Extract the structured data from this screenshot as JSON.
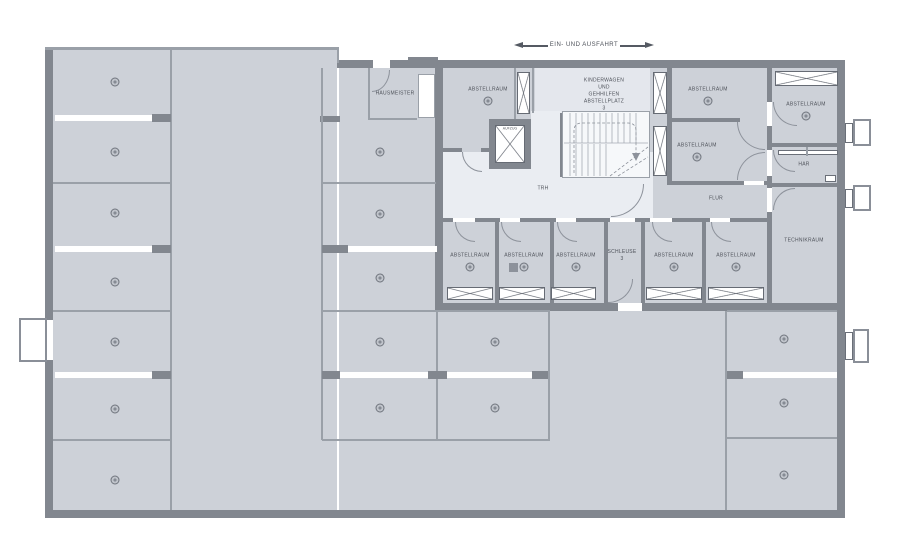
{
  "annotation": {
    "entrance_label": "EIN- UND AUSFAHRT"
  },
  "colors": {
    "floor": "#cdd1d8",
    "floor_light": "#e4e7ed",
    "stair_area": "#f6f8fa",
    "wall": "#82878f",
    "thin_line": "#9aa0a8",
    "label_text": "#4e525a",
    "arrow": "#555a63"
  },
  "rooms": [
    {
      "name": "abstellraum-top-left",
      "label": "ABSTELLRAUM",
      "x": 488,
      "y": 90,
      "marker": true
    },
    {
      "name": "kinderwagen-abstellplatz",
      "label": "KINDERWAGEN UND\nGEHHILFEN\nABSTELLPLATZ 3",
      "x": 604,
      "y": 95,
      "marker": false
    },
    {
      "name": "abstellraum-mid-upper",
      "label": "ABSTELLRAUM",
      "x": 708,
      "y": 90,
      "marker": true
    },
    {
      "name": "abstellraum-mid-lower",
      "label": "ABSTELLRAUM",
      "x": 697,
      "y": 146,
      "marker": true
    },
    {
      "name": "abstellraum-top-right",
      "label": "ABSTELLRAUM",
      "x": 806,
      "y": 105,
      "marker": true
    },
    {
      "name": "har",
      "label": "HAR",
      "x": 804,
      "y": 165,
      "marker": false
    },
    {
      "name": "technikraum",
      "label": "TECHNIKRAUM",
      "x": 804,
      "y": 241,
      "marker": false
    },
    {
      "name": "flur",
      "label": "FLUR",
      "x": 716,
      "y": 199,
      "marker": false
    },
    {
      "name": "trh",
      "label": "TRH",
      "x": 543,
      "y": 189,
      "marker": false
    },
    {
      "name": "hausmeister",
      "label": "HAUSMEISTER",
      "x": 395,
      "y": 94,
      "marker": false
    },
    {
      "name": "aufzug",
      "label": "AUFZUG",
      "x": 510,
      "y": 129,
      "marker": false,
      "small": true
    },
    {
      "name": "abstellraum-row-1",
      "label": "ABSTELLRAUM",
      "x": 470,
      "y": 256,
      "marker": true
    },
    {
      "name": "abstellraum-row-2",
      "label": "ABSTELLRAUM",
      "x": 524,
      "y": 256,
      "marker": true
    },
    {
      "name": "abstellraum-row-3",
      "label": "ABSTELLRAUM",
      "x": 576,
      "y": 256,
      "marker": true
    },
    {
      "name": "schleuse-3",
      "label": "SCHLEUSE 3",
      "x": 622,
      "y": 256,
      "marker": false
    },
    {
      "name": "abstellraum-row-5",
      "label": "ABSTELLRAUM",
      "x": 674,
      "y": 256,
      "marker": true
    },
    {
      "name": "abstellraum-row-6",
      "label": "ABSTELLRAUM",
      "x": 736,
      "y": 256,
      "marker": true
    }
  ],
  "parking_spots": [
    {
      "x": 115,
      "y": 82
    },
    {
      "x": 115,
      "y": 152
    },
    {
      "x": 115,
      "y": 213
    },
    {
      "x": 115,
      "y": 282
    },
    {
      "x": 115,
      "y": 342
    },
    {
      "x": 115,
      "y": 409
    },
    {
      "x": 115,
      "y": 480
    },
    {
      "x": 380,
      "y": 152
    },
    {
      "x": 380,
      "y": 214
    },
    {
      "x": 380,
      "y": 278
    },
    {
      "x": 380,
      "y": 342
    },
    {
      "x": 380,
      "y": 408
    },
    {
      "x": 495,
      "y": 342
    },
    {
      "x": 495,
      "y": 408
    },
    {
      "x": 784,
      "y": 339
    },
    {
      "x": 784,
      "y": 403
    },
    {
      "x": 784,
      "y": 475
    }
  ],
  "shafts": [
    {
      "name": "vent-shaft",
      "x": 517,
      "y": 72,
      "w": 13,
      "h": 42
    },
    {
      "name": "vent-shaft",
      "x": 653,
      "y": 72,
      "w": 14,
      "h": 42
    },
    {
      "name": "vent-shaft",
      "x": 653,
      "y": 126,
      "w": 14,
      "h": 50
    },
    {
      "name": "vent-shaft",
      "x": 775,
      "y": 71,
      "w": 63,
      "h": 15
    },
    {
      "name": "vent-grille",
      "x": 447,
      "y": 287,
      "w": 46,
      "h": 13
    },
    {
      "name": "vent-grille",
      "x": 499,
      "y": 287,
      "w": 46,
      "h": 13
    },
    {
      "name": "vent-grille",
      "x": 551,
      "y": 287,
      "w": 45,
      "h": 13
    },
    {
      "name": "vent-grille",
      "x": 646,
      "y": 287,
      "w": 56,
      "h": 13
    },
    {
      "name": "vent-grille",
      "x": 708,
      "y": 287,
      "w": 56,
      "h": 13
    }
  ]
}
